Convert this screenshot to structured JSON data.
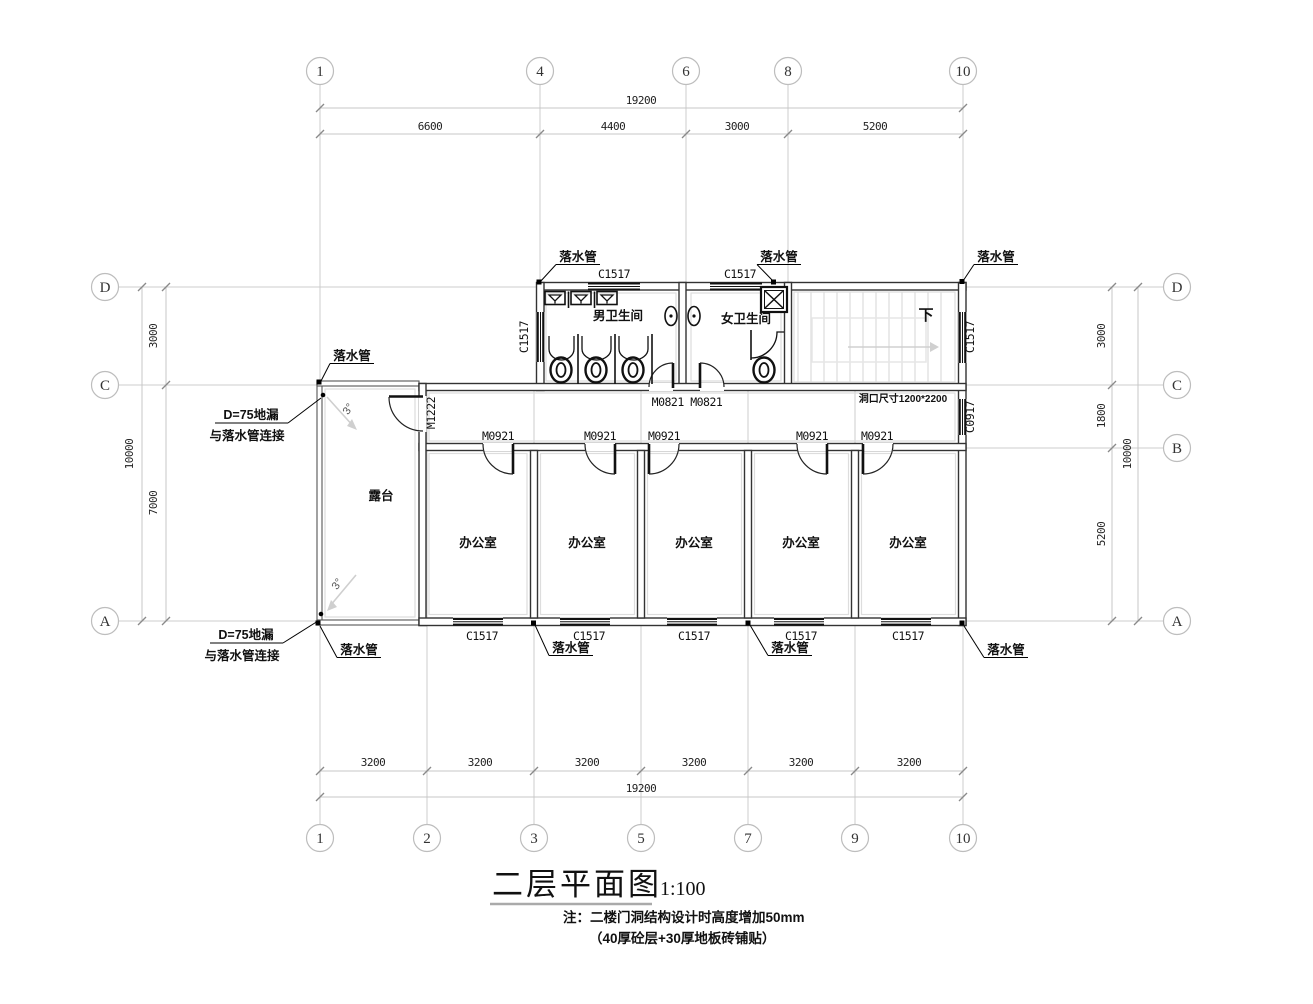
{
  "title_block": {
    "title": "二层平面图",
    "scale": "1:100",
    "note1": "注：二楼门洞结构设计时高度增加50mm",
    "note2": "（40厚砼层+30厚地板砖铺贴）"
  },
  "grid": {
    "top": [
      "1",
      "4",
      "6",
      "8",
      "10"
    ],
    "bottom": [
      "1",
      "2",
      "3",
      "5",
      "7",
      "9",
      "10"
    ],
    "left": [
      "D",
      "C",
      "A"
    ],
    "right": [
      "D",
      "C",
      "B",
      "A"
    ]
  },
  "dims": {
    "top_total": "19200",
    "top_segments": [
      "6600",
      "4400",
      "3000",
      "5200"
    ],
    "bottom_segments": [
      "3200",
      "3200",
      "3200",
      "3200",
      "3200",
      "3200"
    ],
    "bottom_total": "19200",
    "left_segments": [
      "3000",
      "7000"
    ],
    "left_total": "10000",
    "right_segments": [
      "3000",
      "1800",
      "5200"
    ],
    "right_total": "10000"
  },
  "rooms": {
    "men_toilet": "男卫生间",
    "women_toilet": "女卫生间",
    "terrace": "露台",
    "office": "办公室",
    "stair_down": "下"
  },
  "labels": {
    "downpipe": "落水管",
    "c1517": "C1517",
    "c0917": "C0917",
    "m0921": "M0921",
    "m0821_pair": "M0821 M0821",
    "m1222": "M1222",
    "opening_note": "洞口尺寸1200*2200",
    "drain_line1": "D=75地漏",
    "drain_line2": "与落水管连接",
    "slope": "3°"
  },
  "colors": {
    "wall": "#333333",
    "grid": "#cccccc",
    "fixture": "#111111",
    "stair": "#e0e0e0"
  }
}
